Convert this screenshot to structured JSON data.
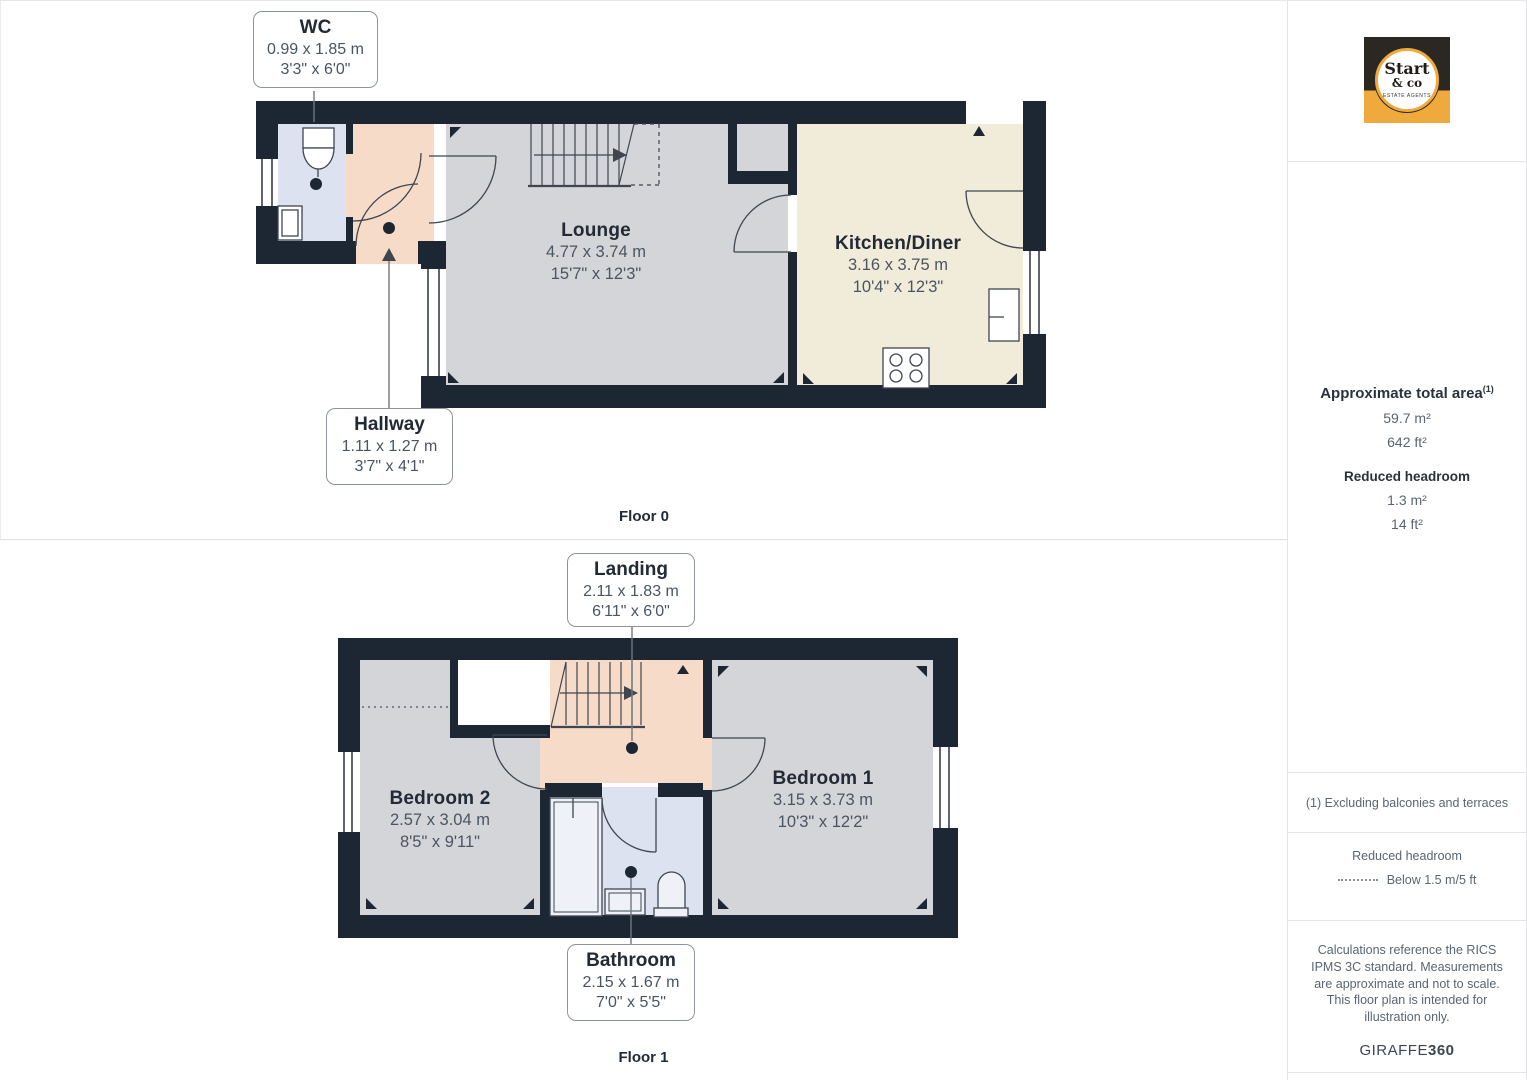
{
  "floors": [
    {
      "label": "Floor 0",
      "rooms": [
        {
          "name": "Lounge",
          "metric": "4.77 x 3.74 m",
          "imperial": "15'7\" x 12'3\""
        },
        {
          "name": "Kitchen/Diner",
          "metric": "3.16 x 3.75 m",
          "imperial": "10'4\" x 12'3\""
        }
      ],
      "callouts": [
        {
          "name": "WC",
          "metric": "0.99 x 1.85 m",
          "imperial": "3'3\" x 6'0\""
        },
        {
          "name": "Hallway",
          "metric": "1.11 x 1.27 m",
          "imperial": "3'7\" x 4'1\""
        }
      ]
    },
    {
      "label": "Floor 1",
      "rooms": [
        {
          "name": "Bedroom 2",
          "metric": "2.57 x 3.04 m",
          "imperial": "8'5\" x 9'11\""
        },
        {
          "name": "Bedroom 1",
          "metric": "3.15 x 3.73 m",
          "imperial": "10'3\" x 12'2\""
        }
      ],
      "callouts": [
        {
          "name": "Landing",
          "metric": "2.11 x 1.83 m",
          "imperial": "6'11\" x 6'0\""
        },
        {
          "name": "Bathroom",
          "metric": "2.15 x 1.67 m",
          "imperial": "7'0\" x 5'5\""
        }
      ]
    }
  ],
  "sidebar": {
    "logo": {
      "line1": "Start",
      "line2": "& co",
      "line3": "ESTATE AGENTS"
    },
    "area": {
      "title": "Approximate total area",
      "marker": "(1)",
      "m2": "59.7 m²",
      "ft2": "642 ft²",
      "reduced_title": "Reduced headroom",
      "reduced_m2": "1.3 m²",
      "reduced_ft2": "14 ft²"
    },
    "footnote": "(1) Excluding balconies and terraces",
    "legend": {
      "title": "Reduced headroom",
      "item": "Below 1.5 m/5 ft"
    },
    "disclaimer": "Calculations reference the RICS IPMS 3C standard. Measurements are approximate and not to scale. This floor plan is intended for illustration only.",
    "brand": {
      "name": "GIRAFFE",
      "suffix": "360"
    }
  },
  "colors": {
    "wall": "#1d2633",
    "room_gray": "#d4d5d8",
    "room_cream": "#f1ecd9",
    "room_peach": "#f6dbc8",
    "room_blue": "#dde2f0",
    "logo_amber": "#f0a93c",
    "logo_dark": "#2b2722"
  }
}
